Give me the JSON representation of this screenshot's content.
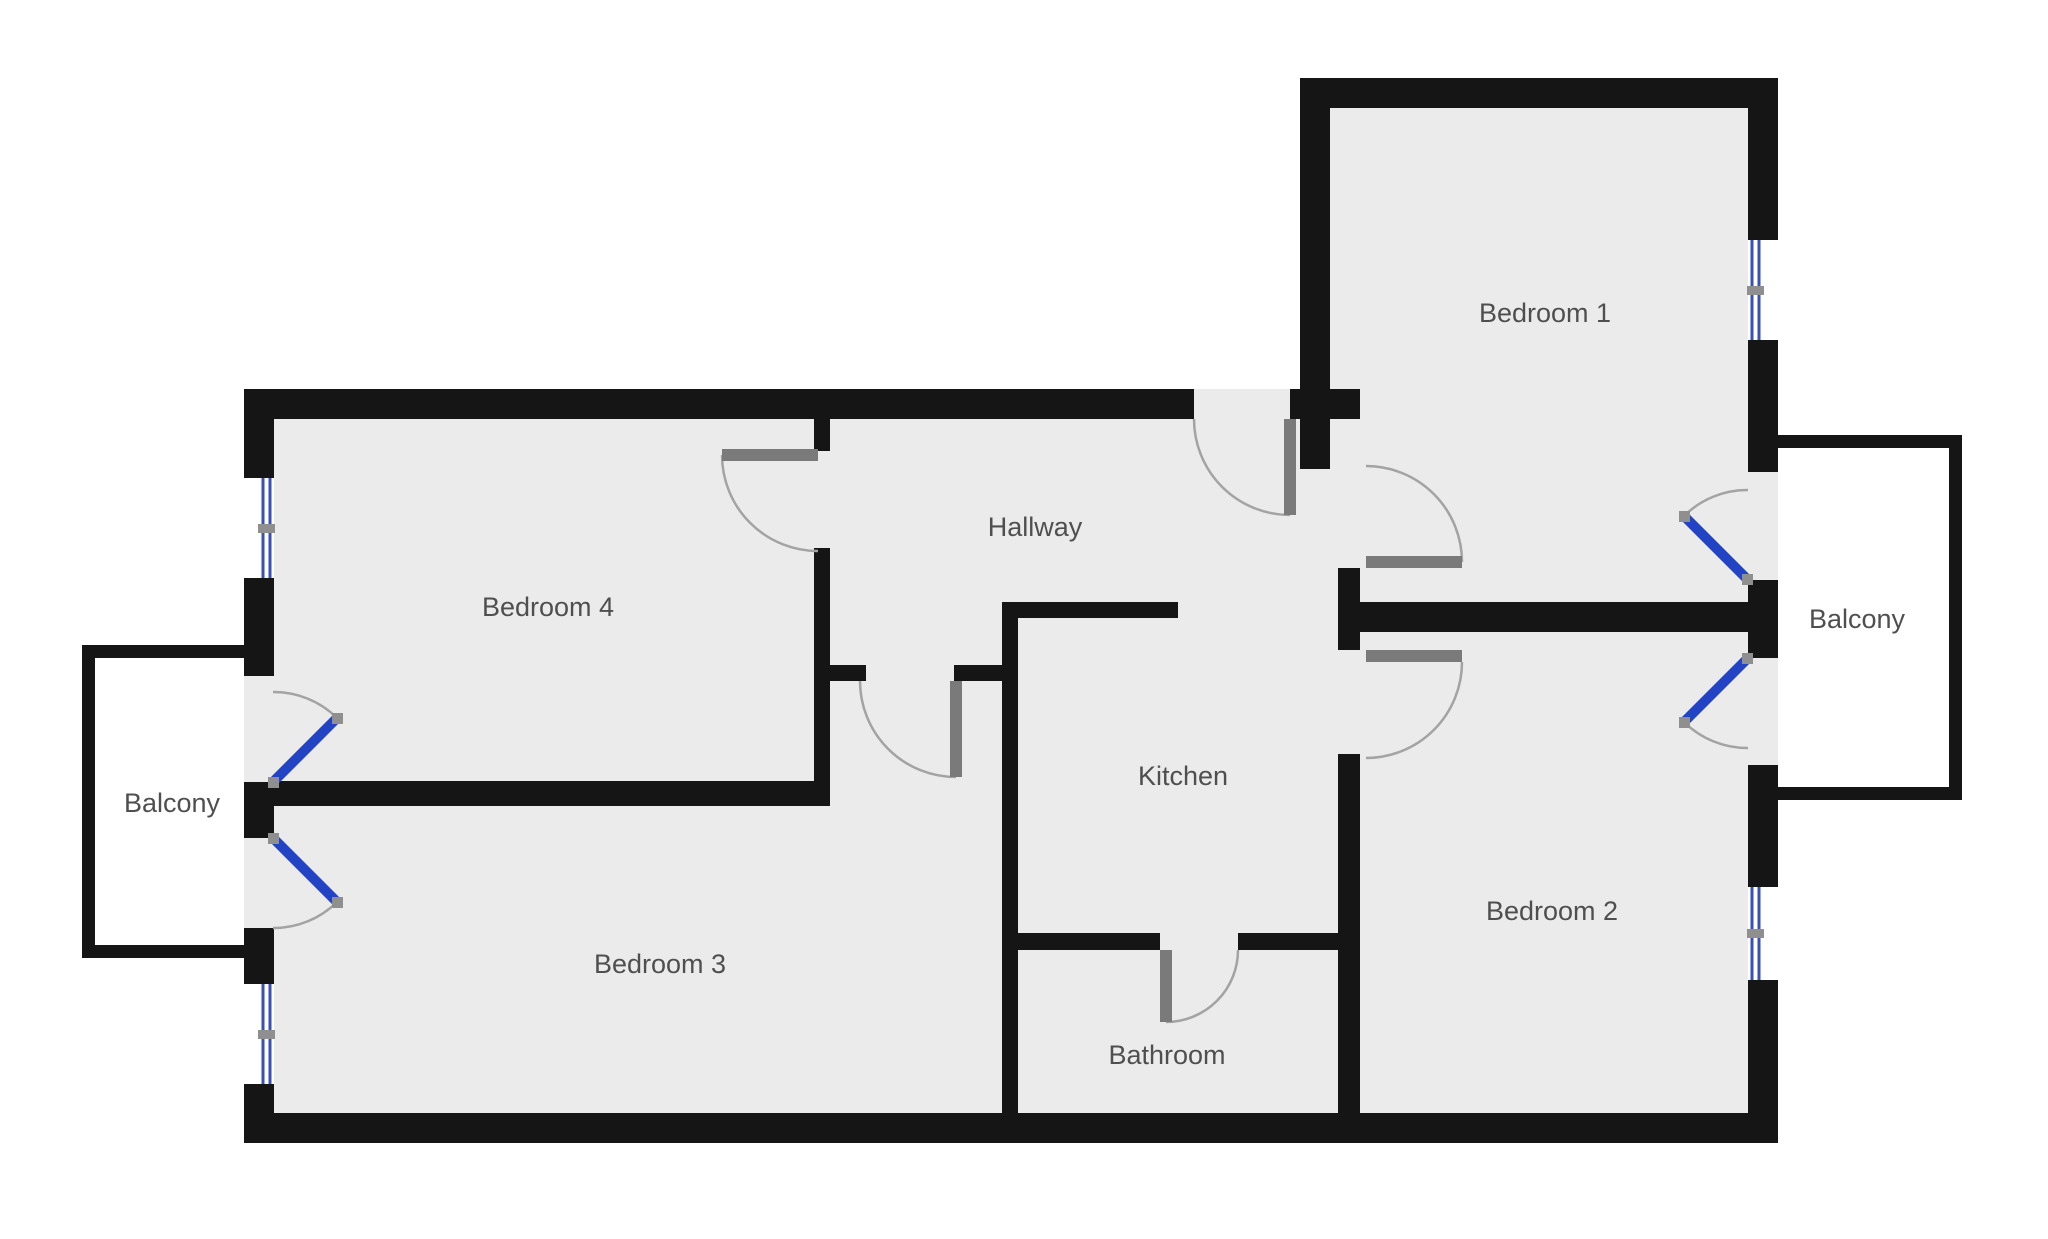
{
  "plan": {
    "type": "apartment-floor-plan",
    "rooms": [
      {
        "label": "Bedroom 1"
      },
      {
        "label": "Bedroom 2"
      },
      {
        "label": "Bedroom 3"
      },
      {
        "label": "Bedroom 4"
      },
      {
        "label": "Hallway"
      },
      {
        "label": "Kitchen"
      },
      {
        "label": "Bathroom"
      },
      {
        "label": "Balcony"
      },
      {
        "label": "Balcony"
      }
    ]
  },
  "colors": {
    "floor": "#ebebeb",
    "wall": "#151515",
    "balcony_floor": "#ffffff",
    "window_glass": "#3a50b4",
    "door_leaf_balcony": "#2243c4",
    "door_leaf_interior": "#7a7a7a",
    "arc": "#a3a3a3",
    "label_text": "#4f4f4f",
    "page_bg": "#ffffff"
  }
}
